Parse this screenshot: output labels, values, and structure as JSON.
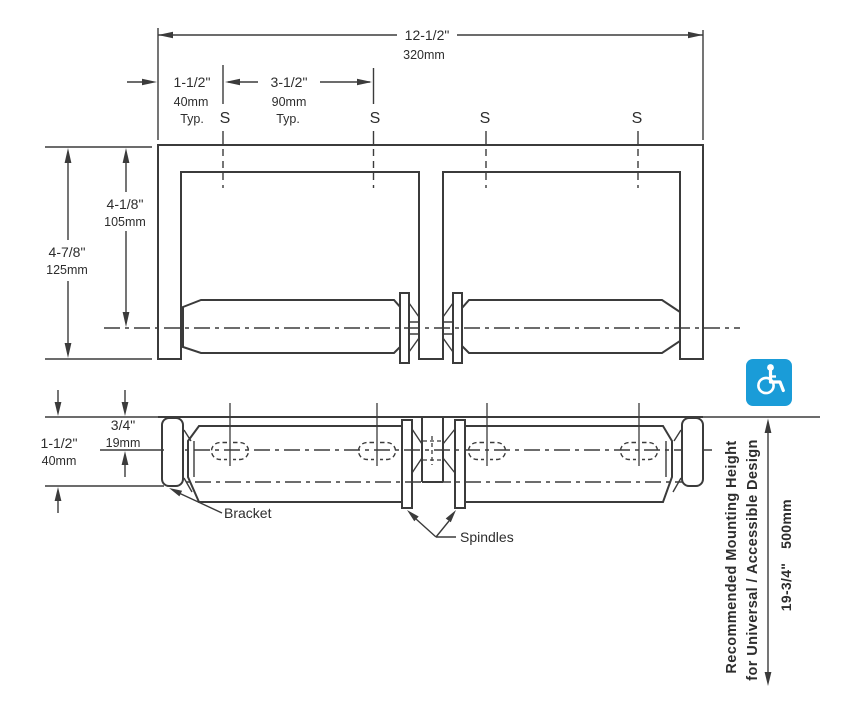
{
  "colors": {
    "line": "#3b3b3b",
    "text": "#2d2d2d",
    "red": "#e5402d",
    "blue": "#1a9cd8"
  },
  "front_view": {
    "overall_width": {
      "in": "12-1/2\"",
      "mm": "320mm"
    },
    "screw_offset": {
      "in": "1-1/2\"",
      "mm": "40mm",
      "note": "Typ."
    },
    "screw_spacing": {
      "in": "3-1/2\"",
      "mm": "90mm",
      "note": "Typ."
    },
    "center_height": {
      "in": "4-1/8\"",
      "mm": "105mm"
    },
    "overall_height": {
      "in": "4-7/8\"",
      "mm": "125mm"
    },
    "screw_labels": [
      "S",
      "S",
      "S",
      "S"
    ]
  },
  "plan_view": {
    "spindle_depth": {
      "in": "3/4\"",
      "mm": "19mm"
    },
    "overall_depth": {
      "in": "1-1/2\"",
      "mm": "40mm"
    },
    "bracket_label": "Bracket",
    "spindles_label": "Spindles"
  },
  "mounting": {
    "note_line1": "Recommended Mounting Height",
    "note_line2": "for Universal / Accessible Design",
    "height_in": "19-3/4\"",
    "height_mm": "500mm",
    "accessibility_icon": "wheelchair-accessibility-symbol"
  }
}
